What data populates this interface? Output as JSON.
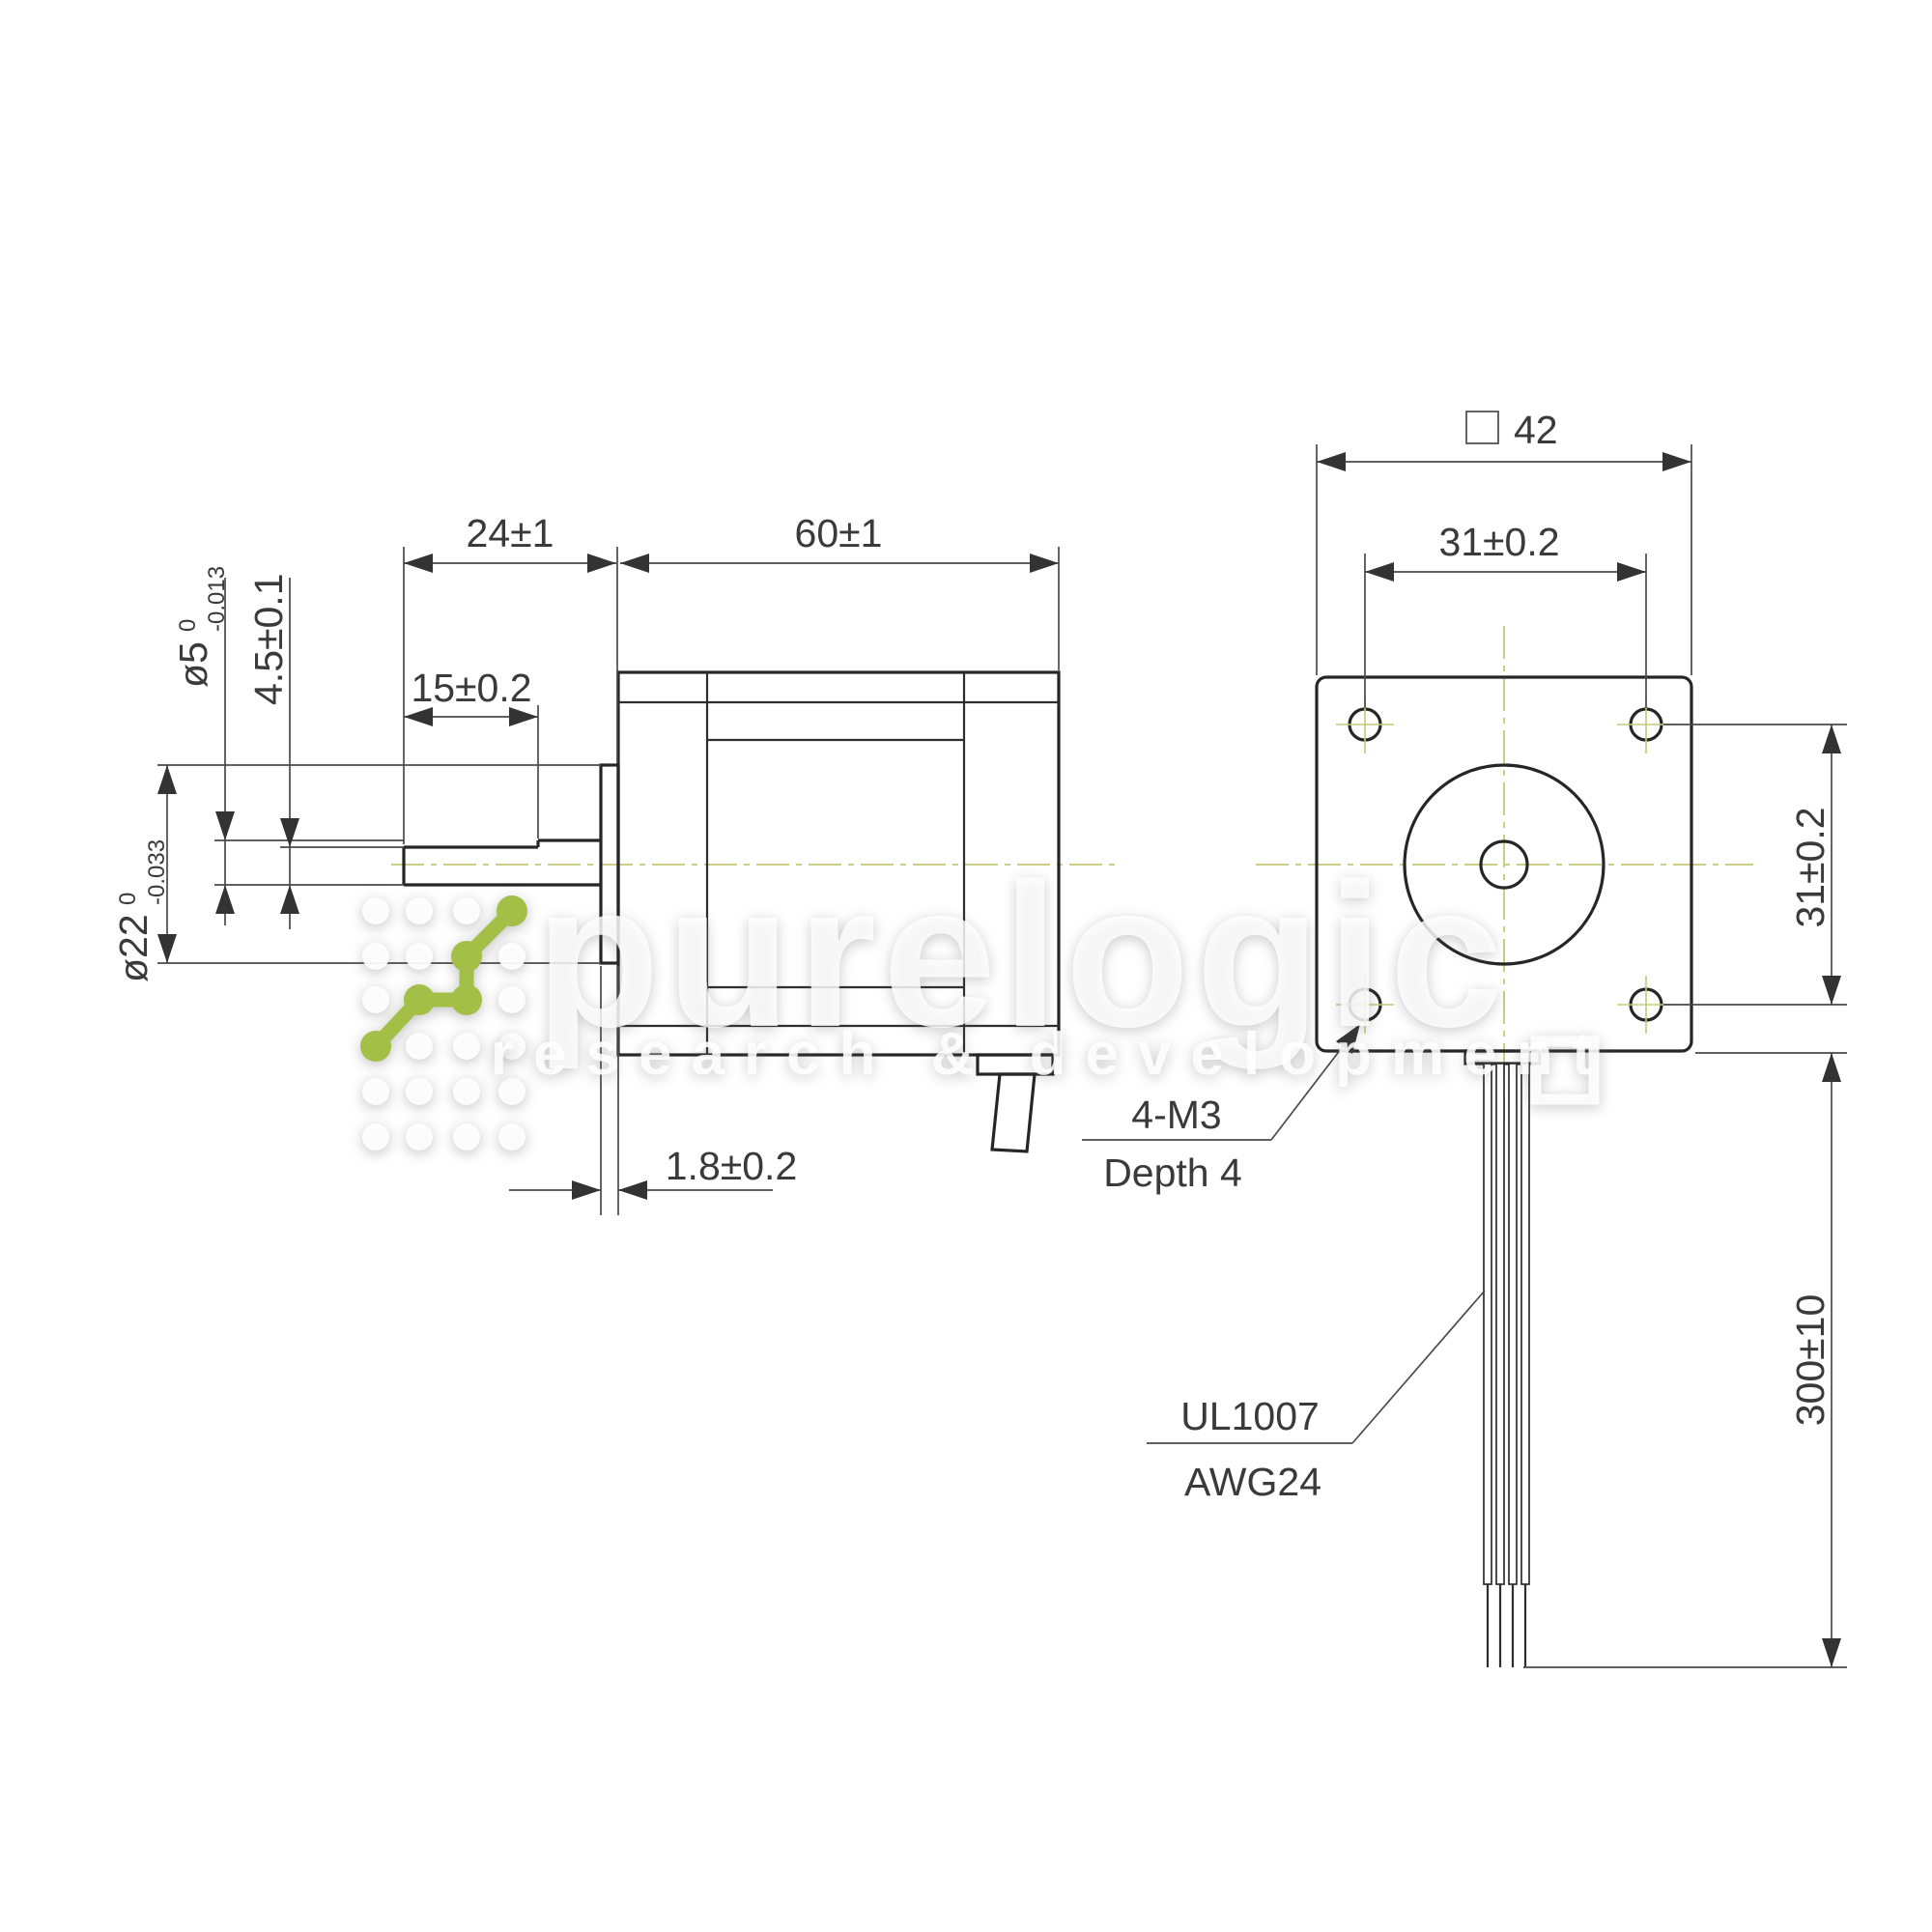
{
  "drawing": {
    "side_view": {
      "dim_shaft_protrusion": "24±1",
      "dim_body_length": "60±1",
      "dim_flat_length": "15±0.2",
      "dim_shaft_diameter": "ø5",
      "dim_shaft_diameter_tol_upper": "0",
      "dim_shaft_diameter_tol_lower": "-0.013",
      "dim_flat_height": "4.5±0.1",
      "dim_boss_diameter": "ø22",
      "dim_boss_diameter_tol_upper": "0",
      "dim_boss_diameter_tol_lower": "-0.033",
      "dim_boss_height": "1.8±0.2"
    },
    "front_view": {
      "dim_square_size": "42",
      "square_symbol": "square-symbol",
      "dim_hole_spacing_horizontal": "31±0.2",
      "dim_hole_spacing_vertical": "31±0.2",
      "dim_lead_length": "300±10",
      "note_mounting_holes_line1": "4-M3",
      "note_mounting_holes_line2": "Depth 4",
      "note_lead_wire_line1": "UL1007",
      "note_lead_wire_line2": "AWG24"
    },
    "watermark": {
      "brand": "purelogic",
      "tagline": "research & development"
    },
    "colors": {
      "line": "#262626",
      "centerline": "#c5c878",
      "logo_green": "#a3bf45",
      "watermark": "#ffffff"
    }
  }
}
